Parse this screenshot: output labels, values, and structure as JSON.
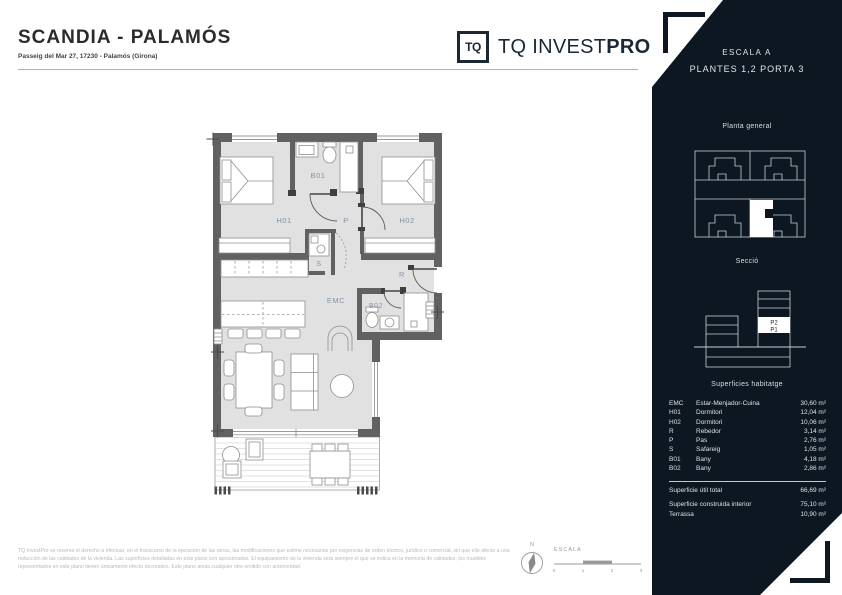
{
  "header": {
    "title": "SCANDIA - PALAMÓS",
    "address": "Passeig del Mar 27, 17230 - Palamós (Girona)"
  },
  "logo": {
    "mark": "TQ",
    "name_regular": "TQ INVEST",
    "name_bold": "PRO"
  },
  "plan": {
    "room_labels": {
      "h01": "H01",
      "h02": "H02",
      "b01": "B01",
      "b02": "B02",
      "emc": "EMC",
      "p": "P",
      "r": "R",
      "s": "S"
    }
  },
  "sidebar": {
    "escala": "ESCALA A",
    "plantes": "PLANTES 1,2 PORTA 3",
    "planta_general_title": "Planta general",
    "seccio_title": "Secció",
    "seccio_labels": {
      "p2": "P2",
      "p1": "P1"
    },
    "surfaces": {
      "title": "Superficies habitatge",
      "rows": [
        {
          "code": "EMC",
          "name": "Estar-Menjador-Cuina",
          "value": "30,60 m²"
        },
        {
          "code": "H01",
          "name": "Dormitori",
          "value": "12,04 m²"
        },
        {
          "code": "H02",
          "name": "Dormitori",
          "value": "10,06 m²"
        },
        {
          "code": "R",
          "name": "Rebedor",
          "value": "3,14 m²"
        },
        {
          "code": "P",
          "name": "Pas",
          "value": "2,76 m²"
        },
        {
          "code": "S",
          "name": "Safareig",
          "value": "1,05 m²"
        },
        {
          "code": "B01",
          "name": "Bany",
          "value": "4,18 m²"
        },
        {
          "code": "B02",
          "name": "Bany",
          "value": "2,86 m²"
        }
      ],
      "total": {
        "name": "Superficie útil total",
        "value": "66,69 m²"
      },
      "extras": [
        {
          "name": "Superficie construida interior",
          "value": "75,10 m²"
        },
        {
          "name": "Terrassa",
          "value": "10,90 m²"
        }
      ]
    }
  },
  "footer": {
    "disclaimer": "TQ InvestPro se reserva el derecho a efectuar, en el transcurso de la ejecución de las obras, las modificaciones que estime necesarias por exigencias de orden técnico, jurídico o comercial, sin que ello afecte a una reducción de las calidades de la vivienda. Las superficies detalladas en este plano son aproximadas. El equipamiento de la vivienda será siempre el que se indica en la memoria de calidades; los muebles representados en este plano tienen únicamente efecto decorativo. Este plano anula cualquier otro emitido con anterioridad.",
    "compass_label": "N",
    "scale_label": "ESCALA",
    "scale_ticks": [
      "0",
      "1",
      "2",
      "3"
    ]
  },
  "colors": {
    "sidebar_bg": "#0d1722",
    "wall": "#616161",
    "floor": "#e1e1e1",
    "room_label": "#8595a7",
    "brand_dark": "#1c2734"
  }
}
